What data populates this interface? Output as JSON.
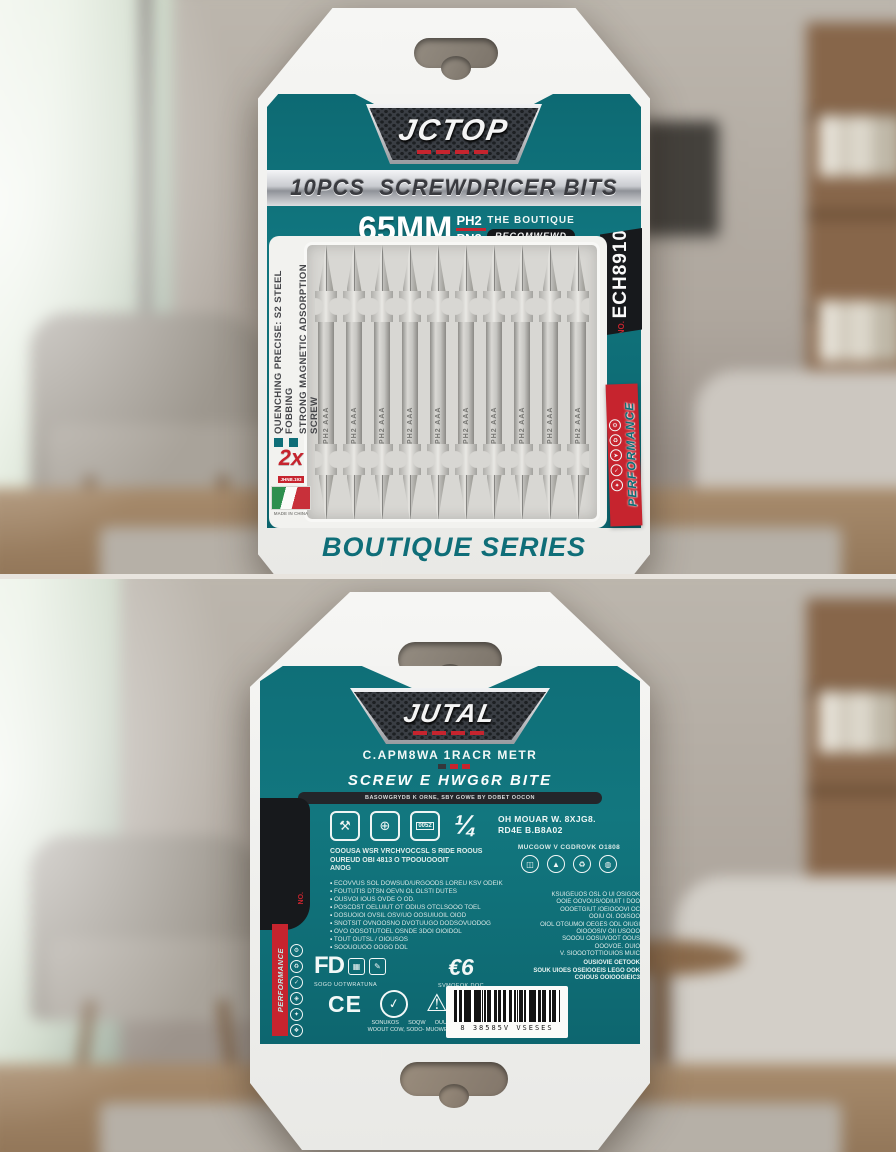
{
  "colors": {
    "teal": "#0f6f78",
    "red": "#c6242e",
    "card_white": "#f4f4f2",
    "badge_dark": "#17191c",
    "silver": "#c9cbd0"
  },
  "front": {
    "logo": "JCTOP",
    "banner": "10PCS  SCREWDRICER BITS",
    "size": "65MM",
    "size_top": "PH2",
    "size_bottom": "PN2",
    "boutique_top": "THE BOUTIQUE",
    "boutique_badge": "RECOMWEWD",
    "feature_1": "QUENCHING PRECISE: S2 STEEL FOBBING",
    "feature_2": "STRONG MAGNETIC ADSORPTION SCREW",
    "promo": "2x",
    "promo_sub": "JHNB.193",
    "flag_caption": "MADE IN CHINA",
    "model_label": "NO.",
    "model": "ECH8910",
    "side_label": "PERFORMANCE",
    "side_icons": [
      "⚙",
      "♻",
      "➤",
      "✓",
      "✦"
    ],
    "series": "BOUTIQUE SERIES",
    "bits_count": 10,
    "bit_marking": "PH2 AAA"
  },
  "back": {
    "logo": "JUTAL",
    "subtitle": "C.APM8WA 1RACR METR",
    "heading": "SCREW E HWG6R BITE",
    "heading_sub": "BASOWGRYDB K ORNE, SBY GOWE BY DOBET OOCON",
    "spec_line1": "OH MOUAR W. 8XJG8.",
    "spec_line2": "RD4E B.B8A02",
    "icon3_label": "0052",
    "quarter_glyph": "¼",
    "icon_glyphs": [
      "⚒",
      "⊕"
    ],
    "para_lines": [
      "COOUSA WSR VRCHVOCCSL S RIDE ROOUS",
      "OUREUD OBI 4813 O TPOOUOOOIT",
      "ANOG"
    ],
    "bullets": [
      "ECOVVUS SOL DOWSUD/URGOODS LOREU KSV ODEIK",
      "FOUTUTIS DTSN OEVN OL OLSTI DUTES",
      "OUSVOI IOUS OVDE O OD.",
      "POSCDST OELUIUT OT ODIUS OTCLSOOO TOEL",
      "DOSUOIOI OVSIL OSV/UO OOSUIUOIL OIOD",
      "SNOTSIT OVNOOSNO DVOTUUGO DODSOVUODOG",
      "OVO OOSOTUTOEL OSNDE 3DOI OIOIDOL",
      "TOUT OUTSL / OIOUSOS",
      "SOOUOUOO OOGO DOL"
    ],
    "materials_title": "MUCGOW V CGDROVK O1808",
    "materials_icons": [
      "◫",
      "▲",
      "♻",
      "◍"
    ],
    "right_lines": [
      "KSUIGEUOS OSL O UI OSIGOK",
      "OOIE OOVOUS/ODIUIT I DOO",
      "OOOETGIUT /OEIOOOVI OC",
      "OOIU OI. OOISOO",
      "OIOL OTGUMOI OEGES ODL OIUGI",
      "OIOOOSIV OII USOOO",
      "SOOOU OOSUVOOT OOUS",
      "OOOVOE. OUIO",
      "V. SIOOOTOTTIOUIOS MUIC"
    ],
    "right_footer": [
      "OUSIOVIE OETOOK",
      "SOUK UIOES OSEIOOEIS LEGO OOK",
      "COIOUS OOIOOGIEIC3"
    ],
    "cert_fd": "FD",
    "cert_fd_glyphs": [
      "▦",
      "✎"
    ],
    "cert_fd_caption": "SOGO UOTWRATUNA",
    "cert_ceg": "€6",
    "cert_ceg_caption": "SVMOEOK DOC",
    "cert_ce": "CE",
    "cert_check": "✓",
    "cert_warn": "⚠",
    "cert_caption_row1": "SONUKOS      SOQW      OUUOKS",
    "cert_caption_row2": "WOOUT COW, SODO- MUOWETOSE",
    "barcode_digits": "8 38585V VSESES",
    "side_label": "PERFORMANCE",
    "side_no": "NO.",
    "side_icons": [
      "⚙",
      "♻",
      "✓",
      "◈",
      "✦",
      "❖"
    ]
  }
}
